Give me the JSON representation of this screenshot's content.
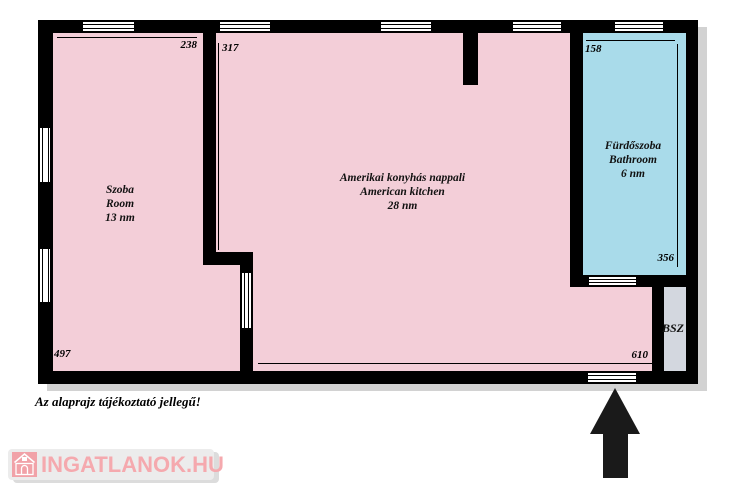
{
  "plan": {
    "rooms": [
      {
        "name_hu": "Szoba",
        "name_en": "Room",
        "area": "13 nm",
        "dim_width": "238",
        "dim_height": "497"
      },
      {
        "name_hu": "Amerikai konyhás nappali",
        "name_en": "American kitchen",
        "area": "28 nm",
        "dim_height": "317",
        "dim_width": "610"
      },
      {
        "name_hu": "Fürdőszoba",
        "name_en": "Bathroom",
        "area": "6 nm",
        "dim_width": "158",
        "dim_height": "356"
      },
      {
        "abbr": "BSZ"
      }
    ],
    "note": "Az alaprajz tájékoztató jellegű!"
  },
  "branding": {
    "logo_text": "INGATLANOK.HU"
  },
  "colors": {
    "room_fill": "#f3ced8",
    "bathroom_fill": "#a9dbea",
    "bsz_fill": "#d3d7df",
    "wall": "#000000",
    "logo_pink": "#f5a9ae",
    "logo_bg": "#ececec"
  }
}
